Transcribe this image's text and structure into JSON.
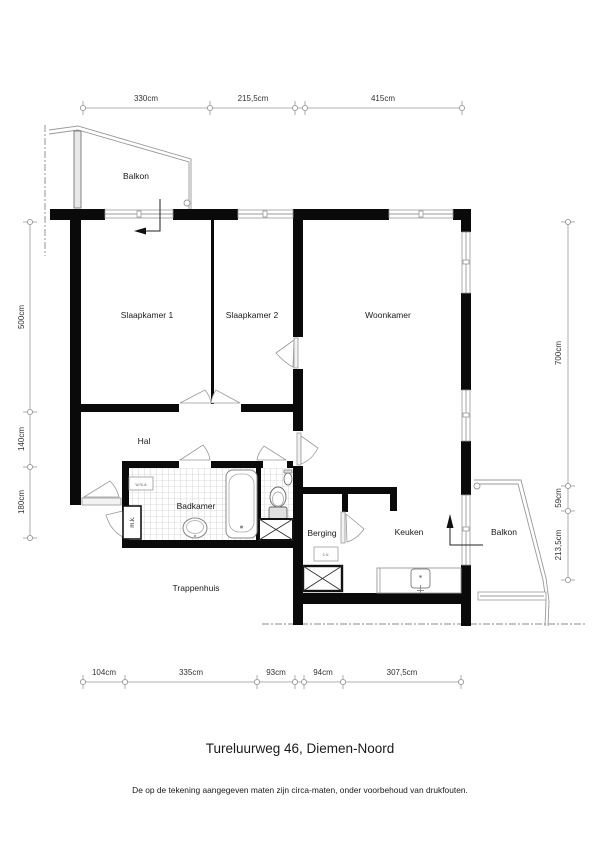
{
  "plan": {
    "title": "Tureluurweg 46, Diemen-Noord",
    "disclaimer": "De op de tekening aangegeven maten zijn circa-maten, onder voorbehoud van drukfouten."
  },
  "rooms": {
    "balcony_top": "Balkon",
    "bedroom_1": "Slaapkamer 1",
    "bedroom_2": "Slaapkamer 2",
    "living_room": "Woonkamer",
    "hall": "Hal",
    "bathroom": "Badkamer",
    "storage": "Berging",
    "kitchen": "Keuken",
    "balcony_right": "Balkon",
    "stairwell": "Trappenhuis"
  },
  "labels": {
    "washer_connection": "w.m.a",
    "meter_cupboard": "m.k.",
    "central_heating": "c.v."
  },
  "dimensions": {
    "top": [
      "330cm",
      "215,5cm",
      "415cm"
    ],
    "left": [
      "500cm",
      "140cm",
      "180cm"
    ],
    "right": [
      "700cm",
      "59cm",
      "213,5cm"
    ],
    "bottom": [
      "104cm",
      "335cm",
      "93cm",
      "94cm",
      "307,5cm"
    ]
  }
}
